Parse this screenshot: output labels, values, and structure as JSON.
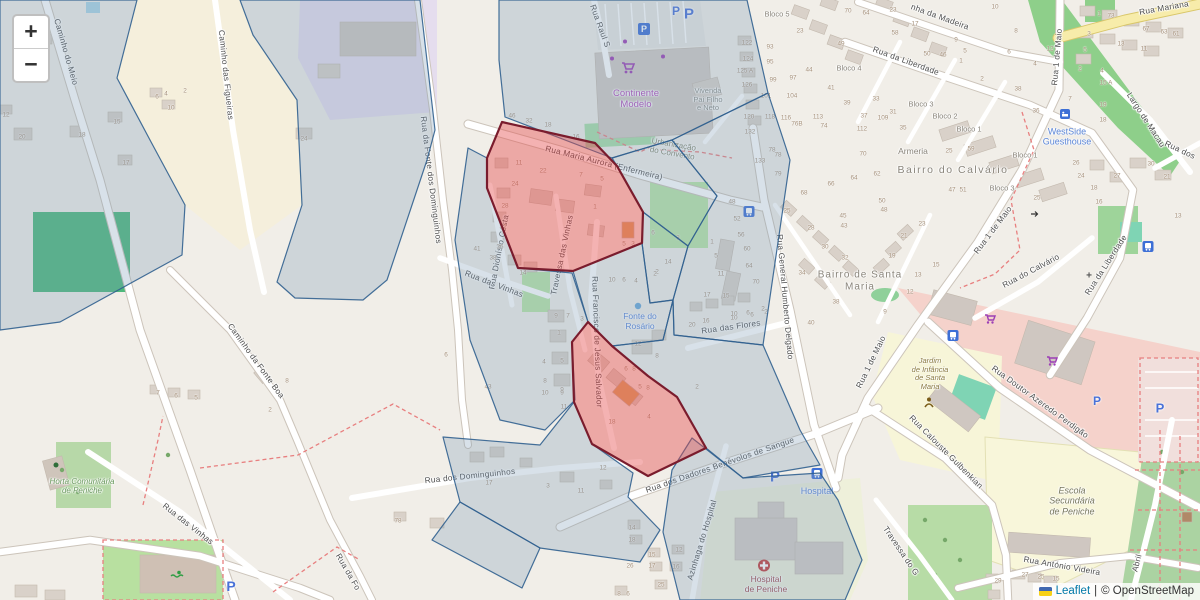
{
  "controls": {
    "zoom_in": "+",
    "zoom_out": "−"
  },
  "attribution": {
    "leaflet": "Leaflet",
    "separator": "|",
    "osm": "© OpenStreetMap"
  },
  "parking_label": "P",
  "icons": {
    "shopping-cart-icon": "purple supermarket cart glyph",
    "parking-sign-icon": "blue square with white P",
    "bus-stop-icon": "blue square with white bus",
    "hospital-cross-icon": "red circle with white cross",
    "fountain-icon": "small blue water dot",
    "swimmer-icon": "green swimmer glyph",
    "kindergarten-icon": "brown child figure",
    "guesthouse-icon": "blue lodging square",
    "chapel-cross-icon": "small gray cross",
    "oneway-arrow-icon": "small dark arrow"
  },
  "colors": {
    "overlay_stroke": "#31618f",
    "overlay_fill": "#7f9cb5",
    "highlight_stroke": "#7a1c2d",
    "highlight_fill": "#e54848"
  },
  "streets": [
    {
      "t": "Caminho do Meio",
      "x": 66,
      "y": 52,
      "r": 74
    },
    {
      "t": "Caminho das Figueiras",
      "x": 226,
      "y": 75,
      "r": 84
    },
    {
      "t": "Rua da Fonte dos Dominguinhos",
      "x": 431,
      "y": 180,
      "r": 83
    },
    {
      "t": "Rua Raul S",
      "x": 600,
      "y": 26,
      "r": 70
    },
    {
      "t": "Rua Maria Aurora (Enfermeira)",
      "x": 604,
      "y": 163,
      "r": 14
    },
    {
      "t": "Rua Dionísio Costa",
      "x": 499,
      "y": 252,
      "r": -79
    },
    {
      "t": "Travessa das Vinhas",
      "x": 562,
      "y": 255,
      "r": -78
    },
    {
      "t": "Rua das Vinhas",
      "x": 494,
      "y": 284,
      "r": 21
    },
    {
      "t": "Rua das Vinhas",
      "x": 188,
      "y": 524,
      "r": 38
    },
    {
      "t": "Rua Francisco de Jesus Salvador",
      "x": 597,
      "y": 342,
      "r": 88
    },
    {
      "t": "Rua dos Dominguinhos",
      "x": 470,
      "y": 476,
      "r": -6
    },
    {
      "t": "Rua dos Dadores Benévolos de Sangue",
      "x": 720,
      "y": 465,
      "r": -19
    },
    {
      "t": "Azinhaga do Hospital",
      "x": 702,
      "y": 540,
      "r": -73
    },
    {
      "t": "Rua das Flores",
      "x": 731,
      "y": 327,
      "r": -8
    },
    {
      "t": "Rua General Humberto Delgado",
      "x": 785,
      "y": 297,
      "r": 85
    },
    {
      "t": "Rua 1 de Maio",
      "x": 1057,
      "y": 57,
      "r": -85
    },
    {
      "t": "Rua 1 de Maio",
      "x": 993,
      "y": 230,
      "r": -53
    },
    {
      "t": "Rua 1 de Maio",
      "x": 871,
      "y": 362,
      "r": -64
    },
    {
      "t": "Rua da Liberdade",
      "x": 906,
      "y": 61,
      "r": 20
    },
    {
      "t": "Rua da Liberdade",
      "x": 1106,
      "y": 265,
      "r": -57
    },
    {
      "t": "Rua do Calvário",
      "x": 1031,
      "y": 271,
      "r": -28
    },
    {
      "t": "nha da Madeira",
      "x": 940,
      "y": 17,
      "r": 20
    },
    {
      "t": "Rua Mariana",
      "x": 1164,
      "y": 8,
      "r": -10
    },
    {
      "t": "Largo de Macau",
      "x": 1146,
      "y": 120,
      "r": 57
    },
    {
      "t": "Rua dos",
      "x": 1180,
      "y": 150,
      "r": 25
    },
    {
      "t": "Rua Doutor Azeredo Perdigão",
      "x": 1040,
      "y": 402,
      "r": 36
    },
    {
      "t": "Rua Calouste Gulbenkian",
      "x": 946,
      "y": 452,
      "r": 45
    },
    {
      "t": "Rua António Videira",
      "x": 1062,
      "y": 566,
      "r": 10
    },
    {
      "t": "Travessa do G",
      "x": 901,
      "y": 551,
      "r": 56
    },
    {
      "t": "Caminho da Fonte Boa",
      "x": 256,
      "y": 361,
      "r": 54
    },
    {
      "t": "Rua da Fo",
      "x": 348,
      "y": 572,
      "r": 60
    },
    {
      "t": "Abril",
      "x": 1137,
      "y": 563,
      "r": -76
    }
  ],
  "places": [
    {
      "lines": [
        "Continente",
        "Modelo"
      ],
      "x": 636,
      "y": 100,
      "c": "#b14cb8",
      "s": 9.5,
      "i": 0
    },
    {
      "lines": [
        "Vivenda",
        "Pai Filho",
        "e Neto"
      ],
      "x": 708,
      "y": 100,
      "c": "#8d8d85",
      "s": 7.5,
      "i": 0
    },
    {
      "lines": [
        "Urbanização",
        "do Convento"
      ],
      "x": 673,
      "y": 149,
      "c": "#84876d",
      "s": 8,
      "i": 0,
      "r": 10
    },
    {
      "lines": [
        "Fonte do",
        "Rosário"
      ],
      "x": 640,
      "y": 322,
      "c": "#5a85d7",
      "s": 8.5,
      "i": 0
    },
    {
      "lines": [
        "Bairro do Calvário"
      ],
      "x": 953,
      "y": 170,
      "c": "#8a857b",
      "s": 10.5,
      "i": 0,
      "ls": 1.5
    },
    {
      "lines": [
        "Bairro de Santa",
        "Maria"
      ],
      "x": 860,
      "y": 281,
      "c": "#8a857b",
      "s": 10,
      "i": 0,
      "ls": 1
    },
    {
      "lines": [
        "Armeria"
      ],
      "x": 913,
      "y": 152,
      "c": "#8a857b",
      "s": 8.5,
      "i": 0
    },
    {
      "lines": [
        "WestSide",
        "Guesthouse"
      ],
      "x": 1067,
      "y": 137,
      "c": "#5a85d7",
      "s": 9,
      "i": 0
    },
    {
      "lines": [
        "Jardim",
        "de Infância",
        "de Santa",
        "Maria"
      ],
      "x": 930,
      "y": 374,
      "c": "#8a7a40",
      "s": 7.5,
      "i": 1
    },
    {
      "lines": [
        "Escola",
        "Secundária",
        "de Peniche"
      ],
      "x": 1072,
      "y": 501,
      "c": "#77775d",
      "s": 9,
      "i": 1
    },
    {
      "lines": [
        "Horta Comunitária",
        "de Peniche"
      ],
      "x": 82,
      "y": 486,
      "c": "#6b9a5f",
      "s": 8,
      "i": 1
    },
    {
      "lines": [
        "Hospital",
        "de Peniche"
      ],
      "x": 766,
      "y": 585,
      "c": "#a04a4a",
      "s": 8.5,
      "i": 0
    },
    {
      "lines": [
        "Hospital"
      ],
      "x": 817,
      "y": 491,
      "c": "#5a85d7",
      "s": 9,
      "i": 0
    },
    {
      "lines": [
        "Bloco 5"
      ],
      "x": 777,
      "y": 15,
      "c": "#8a857b",
      "s": 7.5,
      "i": 0
    },
    {
      "lines": [
        "Bloco 4"
      ],
      "x": 849,
      "y": 69,
      "c": "#8a857b",
      "s": 7.5,
      "i": 0
    },
    {
      "lines": [
        "Bloco 3"
      ],
      "x": 921,
      "y": 105,
      "c": "#8a857b",
      "s": 7.5,
      "i": 0
    },
    {
      "lines": [
        "Bloco 2"
      ],
      "x": 945,
      "y": 117,
      "c": "#8a857b",
      "s": 7.5,
      "i": 0
    },
    {
      "lines": [
        "Bloco 1"
      ],
      "x": 969,
      "y": 130,
      "c": "#8a857b",
      "s": 7.5,
      "i": 0
    },
    {
      "lines": [
        "Bloco 1"
      ],
      "x": 1025,
      "y": 156,
      "c": "#8a857b",
      "s": 7.5,
      "i": 0
    },
    {
      "lines": [
        "Bloco 3"
      ],
      "x": 1002,
      "y": 189,
      "c": "#8a857b",
      "s": 7.5,
      "i": 0
    }
  ],
  "numbers": [
    [
      "20",
      22,
      137
    ],
    [
      "18",
      82,
      135
    ],
    [
      "15",
      117,
      122
    ],
    [
      "17",
      126,
      163
    ],
    [
      "10",
      171,
      108
    ],
    [
      "6",
      157,
      97
    ],
    [
      "4",
      166,
      94
    ],
    [
      "2",
      185,
      91
    ],
    [
      "12",
      6,
      115
    ],
    [
      "0",
      46,
      42
    ],
    [
      "24",
      304,
      139
    ],
    [
      "46",
      512,
      116
    ],
    [
      "32",
      529,
      121
    ],
    [
      "18",
      548,
      125
    ],
    [
      "16",
      576,
      137
    ],
    [
      "11",
      519,
      163
    ],
    [
      "22",
      543,
      171
    ],
    [
      "24",
      515,
      184
    ],
    [
      "28",
      505,
      206
    ],
    [
      "32",
      503,
      227
    ],
    [
      "36",
      500,
      247
    ],
    [
      "41",
      477,
      249
    ],
    [
      "38",
      493,
      258
    ],
    [
      "14",
      523,
      273
    ],
    [
      "7",
      581,
      175
    ],
    [
      "5",
      602,
      179
    ],
    [
      "1",
      595,
      207
    ],
    [
      "5",
      624,
      244
    ],
    [
      "3",
      633,
      244
    ],
    [
      "3",
      678,
      238
    ],
    [
      "6",
      653,
      233
    ],
    [
      "14",
      668,
      262
    ],
    [
      "2",
      657,
      272
    ],
    [
      "10",
      612,
      280
    ],
    [
      "6",
      624,
      280
    ],
    [
      "4",
      636,
      281
    ],
    [
      "2",
      655,
      274
    ],
    [
      "9",
      556,
      316
    ],
    [
      "7",
      568,
      316
    ],
    [
      "3",
      582,
      319
    ],
    [
      "1",
      559,
      333
    ],
    [
      "5",
      562,
      361
    ],
    [
      "4",
      544,
      362
    ],
    [
      "8",
      545,
      381
    ],
    [
      "9",
      562,
      390
    ],
    [
      "11",
      564,
      407
    ],
    [
      "6",
      626,
      369
    ],
    [
      "8",
      634,
      369
    ],
    [
      "5",
      640,
      387
    ],
    [
      "8",
      648,
      388
    ],
    [
      "4",
      649,
      417
    ],
    [
      "18",
      612,
      422
    ],
    [
      "12",
      638,
      344
    ],
    [
      "8",
      657,
      356
    ],
    [
      "2",
      697,
      387
    ],
    [
      "20",
      692,
      325
    ],
    [
      "16",
      706,
      321
    ],
    [
      "10",
      734,
      318
    ],
    [
      "6",
      752,
      315
    ],
    [
      "2",
      766,
      312
    ],
    [
      "12",
      603,
      468
    ],
    [
      "11",
      581,
      491
    ],
    [
      "3",
      548,
      486
    ],
    [
      "17",
      489,
      483
    ],
    [
      "43",
      488,
      387
    ],
    [
      "10",
      545,
      393
    ],
    [
      "9",
      562,
      393
    ],
    [
      "6",
      446,
      355
    ],
    [
      "14",
      632,
      528
    ],
    [
      "18",
      632,
      540
    ],
    [
      "15",
      652,
      555
    ],
    [
      "17",
      652,
      566
    ],
    [
      "12",
      679,
      550
    ],
    [
      "16",
      676,
      567
    ],
    [
      "25",
      661,
      585
    ],
    [
      "26",
      630,
      566
    ],
    [
      "8",
      619,
      594
    ],
    [
      "6",
      628,
      594
    ],
    [
      "78",
      778,
      155
    ],
    [
      "133",
      760,
      161
    ],
    [
      "79",
      778,
      174
    ],
    [
      "70",
      863,
      154
    ],
    [
      "64",
      854,
      178
    ],
    [
      "62",
      877,
      174
    ],
    [
      "66",
      831,
      184
    ],
    [
      "68",
      804,
      193
    ],
    [
      "50",
      882,
      201
    ],
    [
      "48",
      884,
      210
    ],
    [
      "45",
      843,
      216
    ],
    [
      "43",
      844,
      226
    ],
    [
      "25",
      787,
      211
    ],
    [
      "28",
      811,
      228
    ],
    [
      "30",
      825,
      247
    ],
    [
      "32",
      845,
      258
    ],
    [
      "34",
      802,
      273
    ],
    [
      "38",
      836,
      302
    ],
    [
      "40",
      811,
      323
    ],
    [
      "23",
      922,
      224
    ],
    [
      "21",
      904,
      236
    ],
    [
      "19",
      892,
      256
    ],
    [
      "15",
      936,
      265
    ],
    [
      "13",
      918,
      275
    ],
    [
      "12",
      910,
      292
    ],
    [
      "9",
      885,
      312
    ],
    [
      "48",
      732,
      202
    ],
    [
      "52",
      737,
      219
    ],
    [
      "56",
      741,
      235
    ],
    [
      "60",
      747,
      249
    ],
    [
      "64",
      749,
      266
    ],
    [
      "70",
      756,
      282
    ],
    [
      "1",
      712,
      242
    ],
    [
      "5",
      716,
      256
    ],
    [
      "11",
      721,
      274
    ],
    [
      "17",
      707,
      295
    ],
    [
      "15",
      726,
      296
    ],
    [
      "10",
      734,
      314
    ],
    [
      "6",
      748,
      313
    ],
    [
      "2",
      763,
      309
    ],
    [
      "70",
      848,
      11
    ],
    [
      "64",
      866,
      13
    ],
    [
      "23",
      893,
      10
    ],
    [
      "17",
      915,
      24
    ],
    [
      "58",
      895,
      33
    ],
    [
      "10",
      995,
      7
    ],
    [
      "50",
      927,
      54
    ],
    [
      "46",
      943,
      55
    ],
    [
      "9",
      956,
      40
    ],
    [
      "5",
      965,
      51
    ],
    [
      "1",
      961,
      61
    ],
    [
      "2",
      982,
      79
    ],
    [
      "23",
      800,
      31
    ],
    [
      "49",
      841,
      44
    ],
    [
      "93",
      770,
      47
    ],
    [
      "95",
      770,
      62
    ],
    [
      "97",
      793,
      78
    ],
    [
      "99",
      773,
      80
    ],
    [
      "101",
      766,
      96
    ],
    [
      "104",
      792,
      96
    ],
    [
      "44",
      809,
      70
    ],
    [
      "41",
      831,
      88
    ],
    [
      "39",
      847,
      103
    ],
    [
      "33",
      876,
      99
    ],
    [
      "37",
      864,
      116
    ],
    [
      "31",
      893,
      112
    ],
    [
      "35",
      903,
      128
    ],
    [
      "109",
      883,
      118
    ],
    [
      "112",
      862,
      129
    ],
    [
      "113",
      818,
      117
    ],
    [
      "118",
      770,
      117
    ],
    [
      "116",
      786,
      118
    ],
    [
      "76B",
      797,
      124
    ],
    [
      "74",
      824,
      126
    ],
    [
      "122",
      747,
      43
    ],
    [
      "124",
      748,
      59
    ],
    [
      "125 A",
      745,
      71
    ],
    [
      "126",
      747,
      85
    ],
    [
      "120",
      749,
      117
    ],
    [
      "132",
      750,
      132
    ],
    [
      "78",
      772,
      150
    ],
    [
      "1",
      1099,
      14
    ],
    [
      "73",
      1111,
      16
    ],
    [
      "67",
      1146,
      29
    ],
    [
      "63",
      1164,
      32
    ],
    [
      "61",
      1176,
      34
    ],
    [
      "3",
      1089,
      34
    ],
    [
      "13",
      1121,
      44
    ],
    [
      "11",
      1144,
      49
    ],
    [
      "5",
      1085,
      50
    ],
    [
      "2",
      1080,
      69
    ],
    [
      "4",
      1102,
      71
    ],
    [
      "15 A",
      1106,
      83
    ],
    [
      "8",
      1016,
      31
    ],
    [
      "6",
      1009,
      52
    ],
    [
      "12",
      1050,
      49
    ],
    [
      "4",
      1035,
      64
    ],
    [
      "38",
      1018,
      89
    ],
    [
      "36",
      1036,
      111
    ],
    [
      "7",
      1070,
      99
    ],
    [
      "19",
      1103,
      105
    ],
    [
      "18",
      1103,
      120
    ],
    [
      "26",
      1076,
      163
    ],
    [
      "24",
      1081,
      176
    ],
    [
      "18",
      1094,
      188
    ],
    [
      "16",
      1099,
      202
    ],
    [
      "27",
      1117,
      176
    ],
    [
      "30",
      1151,
      164
    ],
    [
      "21",
      1167,
      177
    ],
    [
      "13",
      1178,
      216
    ],
    [
      "25",
      1037,
      198
    ],
    [
      "25",
      949,
      151
    ],
    [
      "59",
      971,
      149
    ],
    [
      "47",
      952,
      190
    ],
    [
      "51",
      963,
      190
    ],
    [
      "7",
      158,
      393
    ],
    [
      "6",
      176,
      396
    ],
    [
      "5",
      196,
      398
    ],
    [
      "8",
      287,
      381
    ],
    [
      "2",
      270,
      410
    ],
    [
      "27",
      1025,
      575
    ],
    [
      "25",
      1041,
      577
    ],
    [
      "15",
      1056,
      579
    ],
    [
      "29",
      998,
      581
    ],
    [
      "78",
      398,
      521
    ]
  ],
  "parking": [
    {
      "x": 676,
      "y": 11,
      "s": 12
    },
    {
      "x": 689,
      "y": 14,
      "s": 15
    },
    {
      "x": 775,
      "y": 477,
      "s": 15
    },
    {
      "x": 231,
      "y": 586,
      "s": 14
    },
    {
      "x": 1097,
      "y": 401,
      "s": 12
    },
    {
      "x": 1160,
      "y": 408,
      "s": 13
    }
  ]
}
